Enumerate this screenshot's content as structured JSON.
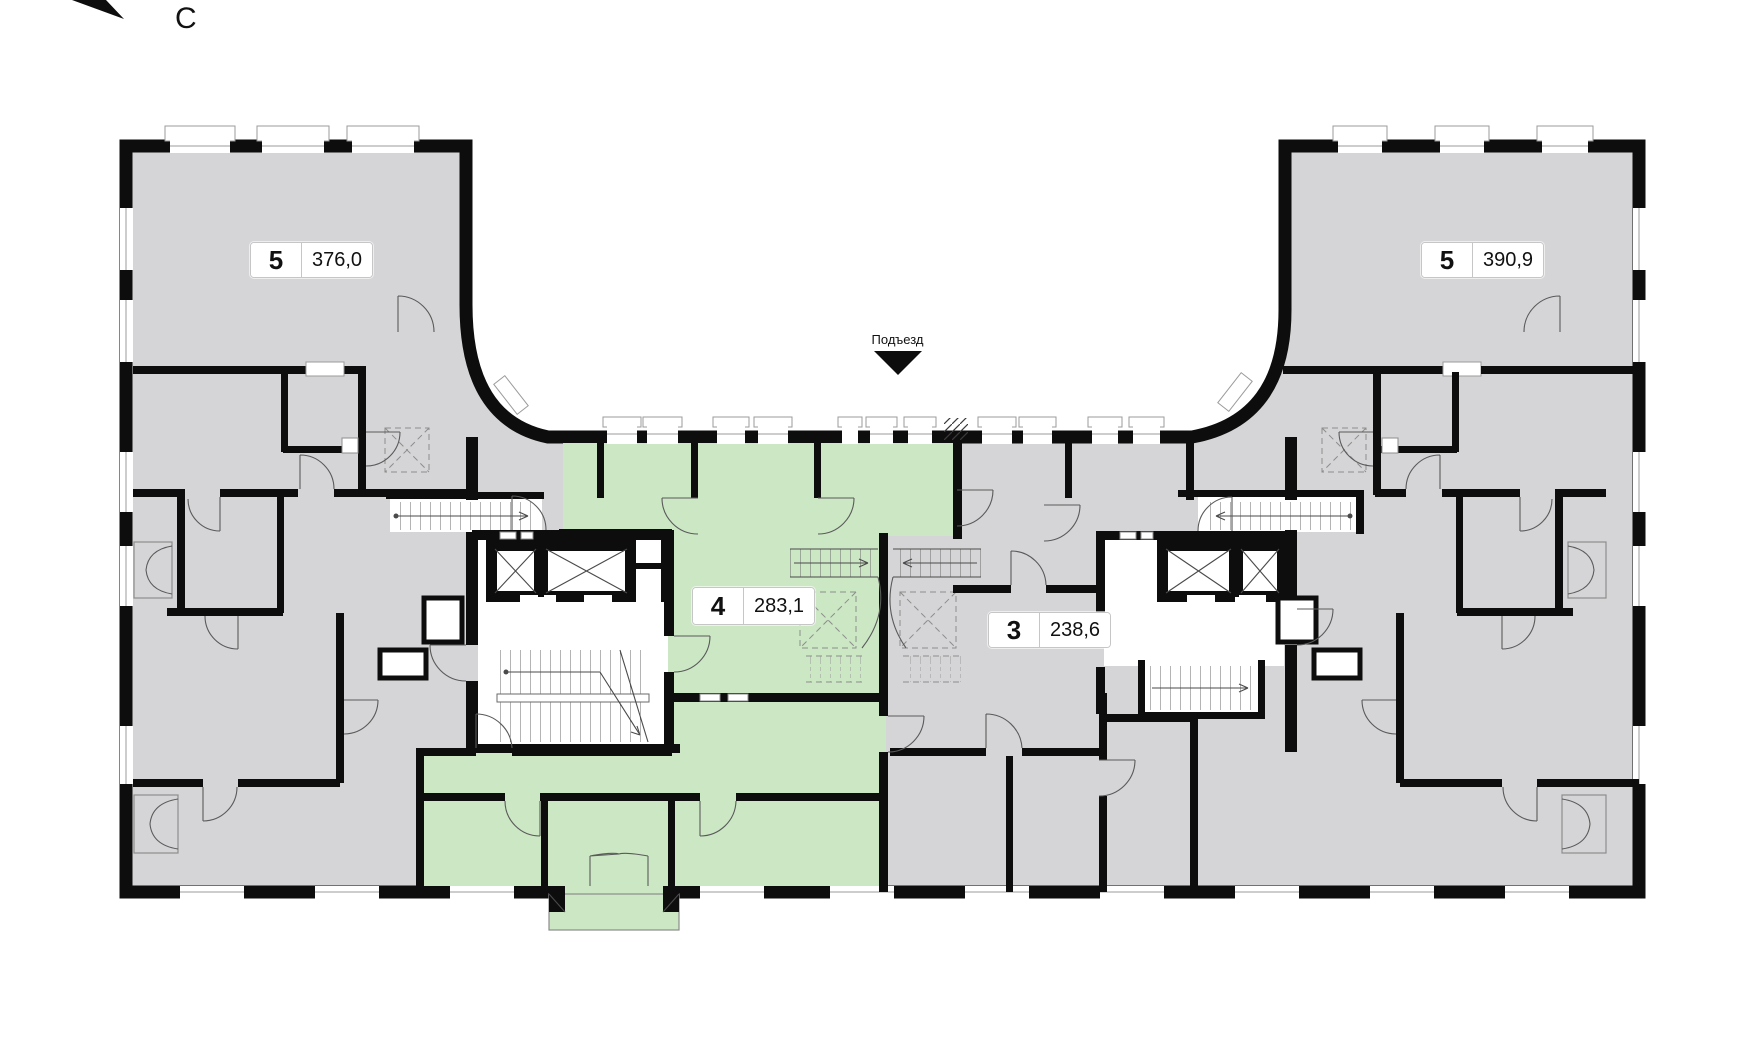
{
  "compass": {
    "label": "С"
  },
  "entrance": {
    "label": "Подъезд"
  },
  "apartments": [
    {
      "id": "left-wing-5",
      "number": "5",
      "area": "376,0",
      "highlighted": false
    },
    {
      "id": "center-4",
      "number": "4",
      "area": "283,1",
      "highlighted": true
    },
    {
      "id": "center-3",
      "number": "3",
      "area": "238,6",
      "highlighted": false
    },
    {
      "id": "right-wing-5",
      "number": "5",
      "area": "390,9",
      "highlighted": false
    }
  ],
  "colors": {
    "apartment_fill": "#d5d5d7",
    "highlight_fill": "#cce7c4",
    "wall": "#0d0d0d",
    "label_border": "#c6c6c6"
  }
}
